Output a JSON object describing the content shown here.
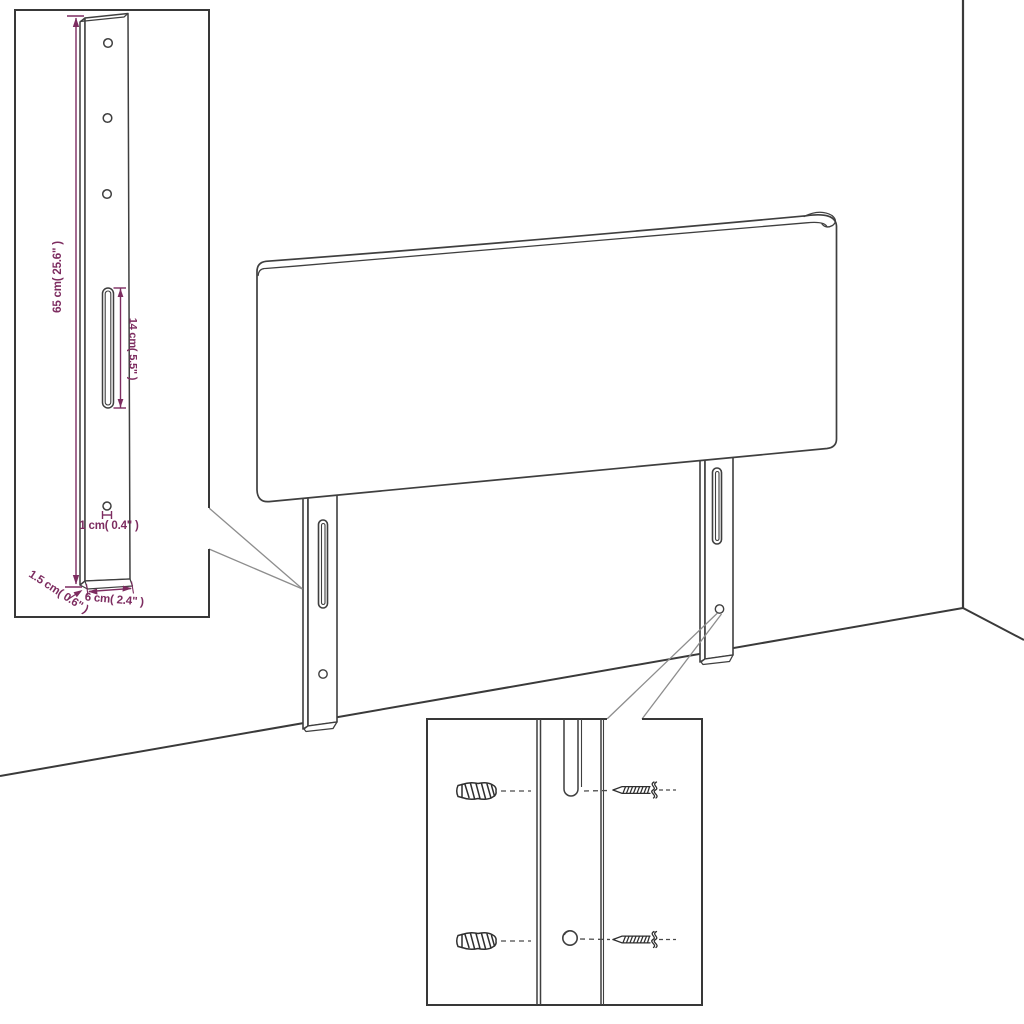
{
  "title": "Headboard with legs assembly diagram",
  "colors": {
    "line": "#3f3f3f",
    "wall_line": "#3a3a3a",
    "dimension_accent": "#7d2c60",
    "background": "#ffffff"
  },
  "insets": {
    "bracket_detail": {
      "dimensions": {
        "height": "65 cm( 25.6\" )",
        "slot_length": "14 cm( 5.5\" )",
        "hole_diameter": "1 cm( 0.4\" )",
        "thickness": "1.5 cm( 0.6\" )",
        "width": "6 cm( 2.4\" )"
      }
    },
    "mounting_detail": {
      "parts": [
        "wall-plug-icon",
        "screw-icon",
        "mounting-slot",
        "mounting-hole"
      ]
    }
  }
}
